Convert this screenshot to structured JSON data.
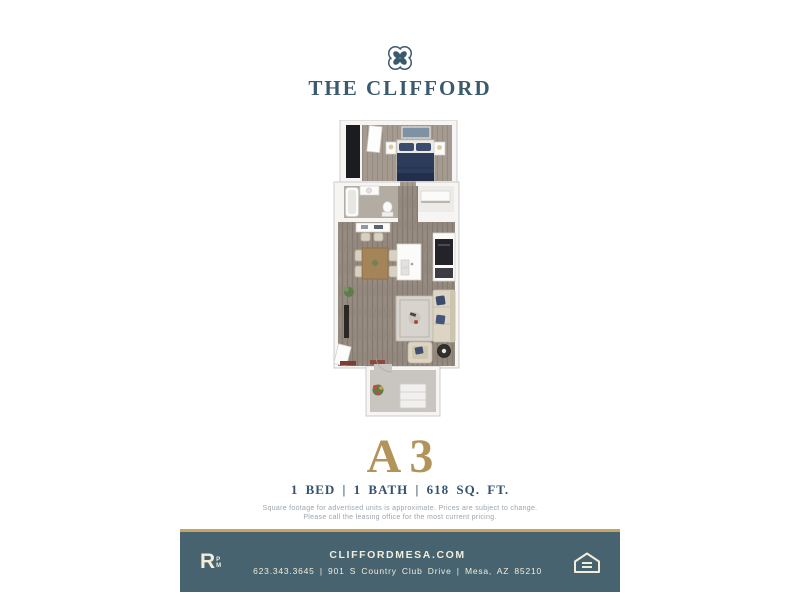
{
  "brand": {
    "name": "THE CLIFFORD",
    "logo_icon": "quatrefoil"
  },
  "unit": {
    "code": "A3",
    "specs": "1 BED | 1 BATH | 618 SQ. FT."
  },
  "disclaimer": {
    "line1": "Square footage for advertised units is approximate. Prices are subject to change.",
    "line2": "Please call the leasing office for the most current pricing."
  },
  "footer": {
    "website": "CLIFFORDMESA.COM",
    "contact_line": "623.343.3645  |  901 S Country Club Drive  |  Mesa, AZ 85210",
    "brand_mark": {
      "letter": "R",
      "small_top": "P",
      "small_bottom": "M"
    },
    "equal_housing_icon": "equal-housing-opportunity"
  },
  "colors": {
    "primary_teal": "#3c5a6e",
    "footer_teal": "#476370",
    "gold": "#b2945a",
    "gold_line": "#c9a265",
    "cream_text": "#f2ecda",
    "disclaimer_gray": "#9aa4ad"
  }
}
